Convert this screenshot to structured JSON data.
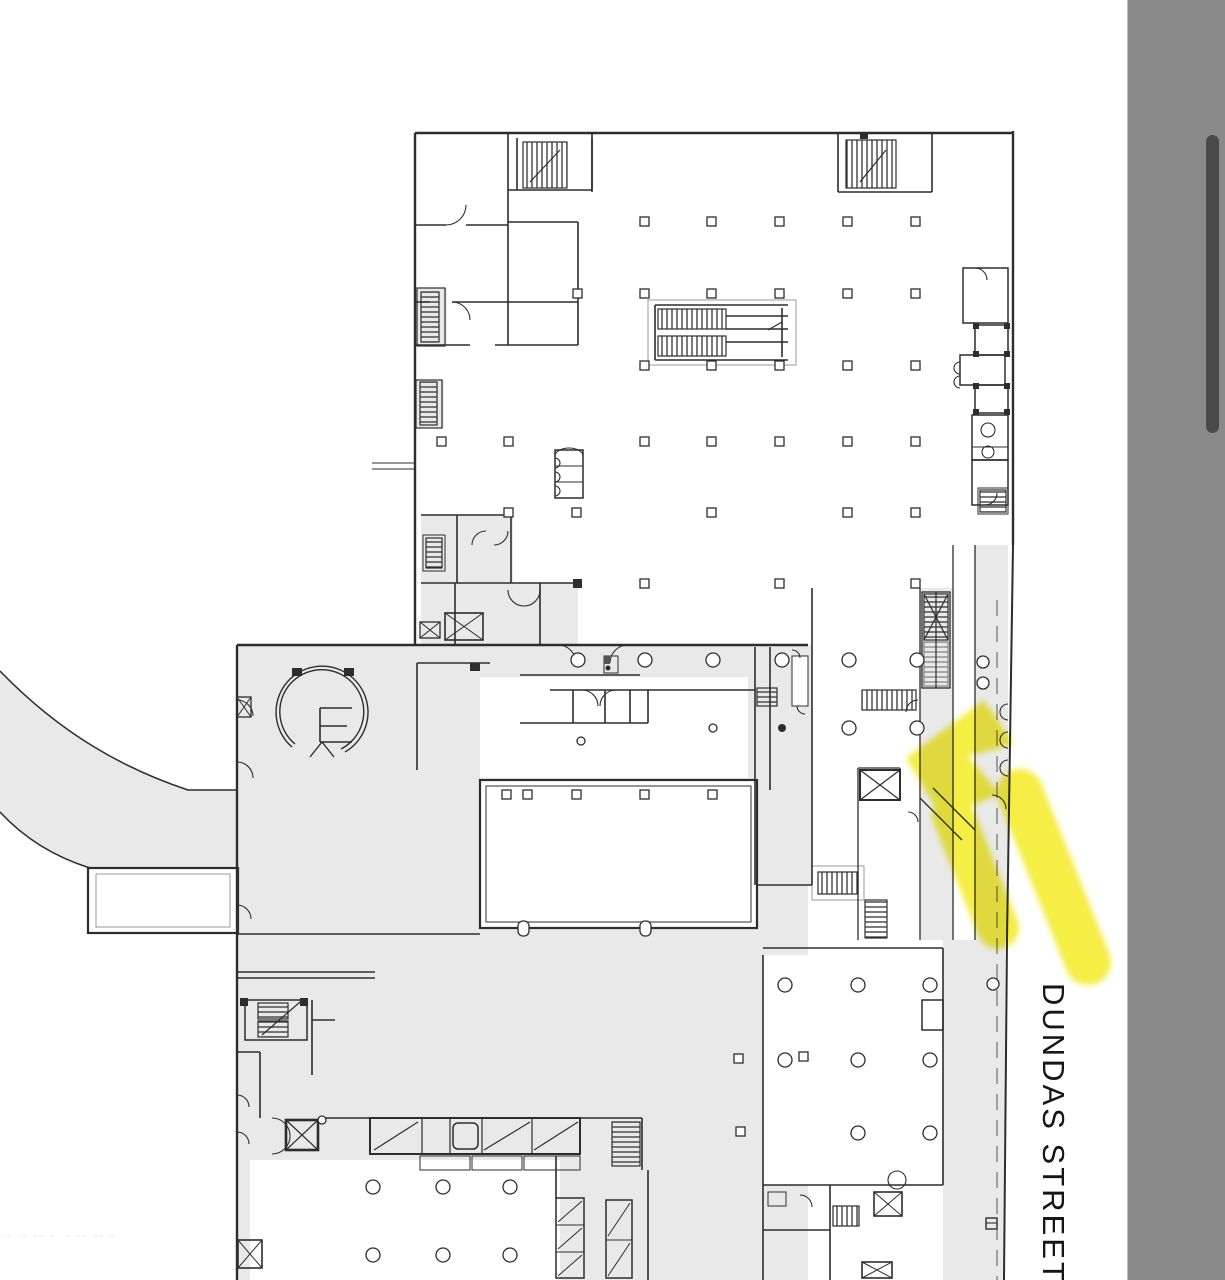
{
  "window": {
    "width": 1225,
    "height": 1280
  },
  "viewer": {
    "scrollbar": {
      "orientation": "vertical",
      "thumb_top_px": 135,
      "thumb_height_px": 298,
      "track_color": "#8a8a8a",
      "thumb_color": "#4a4a4a",
      "track_edge_color": "#bdbdbd"
    },
    "page_color": "#ffffff"
  },
  "floor_plan": {
    "labels": {
      "street_right": "DUNDAS STREET W",
      "street_bottom_left_faint": "·– ·– ––  – ·– –– –– –"
    },
    "colors": {
      "wall": "#2d2d2d",
      "fill_light": "#e9e9e9",
      "guard": "#999999",
      "dark_detail": "#555555",
      "highlight_yellow": "#f2ea1e"
    },
    "annotation": {
      "type": "highlighter-arrow",
      "color": "#f2ea1e",
      "direction": "pointing up-left at street-side entrance"
    }
  }
}
